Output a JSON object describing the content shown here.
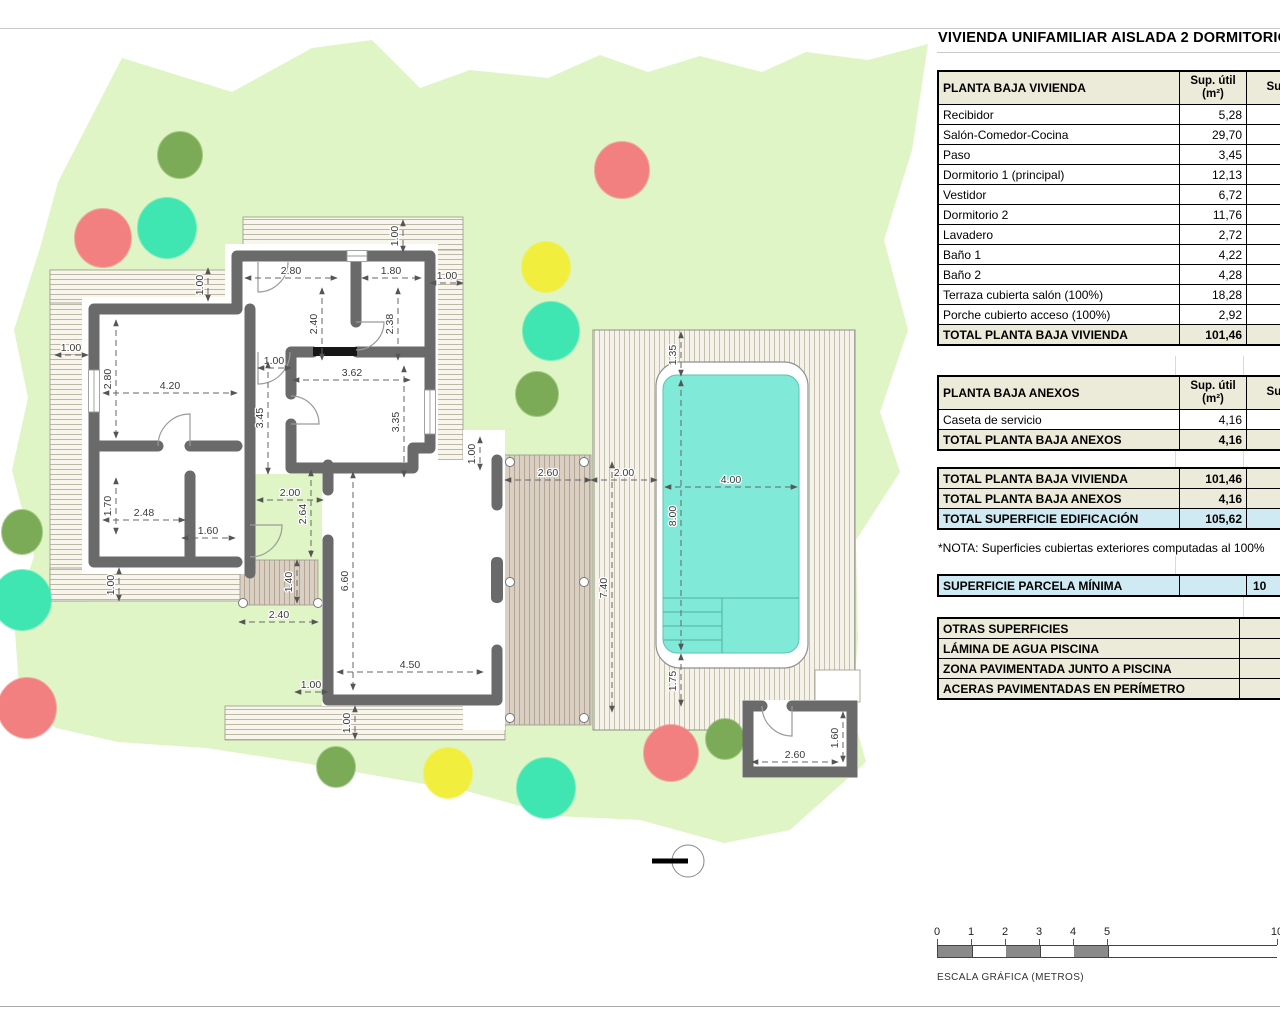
{
  "title": "VIVIENDA UNIFAMILIAR AISLADA 2 DORMITORIOS",
  "panel": {
    "vivienda": {
      "header": "PLANTA BAJA VIVIENDA",
      "col_sup_util": "Sup. útil (m²)",
      "col_sup_2": "Sup.",
      "rows": [
        [
          "Recibidor",
          "5,28"
        ],
        [
          "Salón-Comedor-Cocina",
          "29,70"
        ],
        [
          "Paso",
          "3,45"
        ],
        [
          "Dormitorio 1 (principal)",
          "12,13"
        ],
        [
          "Vestidor",
          "6,72"
        ],
        [
          "Dormitorio 2",
          "11,76"
        ],
        [
          "Lavadero",
          "2,72"
        ],
        [
          "Baño 1",
          "4,22"
        ],
        [
          "Baño 2",
          "4,28"
        ],
        [
          "Terraza cubierta salón (100%)",
          "18,28"
        ],
        [
          "Porche cubierto acceso (100%)",
          "2,92"
        ]
      ],
      "total_label": "TOTAL PLANTA BAJA VIVIENDA",
      "total_value": "101,46"
    },
    "anexos": {
      "header": "PLANTA BAJA ANEXOS",
      "col_sup_util": "Sup. útil (m²)",
      "col_sup_2": "Sup.",
      "rows": [
        [
          "Caseta de servicio",
          "4,16"
        ]
      ],
      "total_label": "TOTAL PLANTA BAJA ANEXOS",
      "total_value": "4,16"
    },
    "resumen": [
      [
        "TOTAL PLANTA BAJA VIVIENDA",
        "101,46",
        "beigerow"
      ],
      [
        "TOTAL PLANTA BAJA ANEXOS",
        "4,16",
        "beigerow"
      ],
      [
        "TOTAL SUPERFICIE EDIFICACIÓN",
        "105,62",
        "blue"
      ]
    ],
    "nota": "*NOTA: Superficies cubiertas exteriores computadas al 100%",
    "parcela_label": "SUPERFICIE PARCELA MÍNIMA",
    "parcela_value": "10",
    "otras_header": "OTRAS SUPERFICIES",
    "otras_rows": [
      "LÁMINA DE AGUA PISCINA",
      "ZONA PAVIMENTADA JUNTO A PISCINA",
      "ACERAS PAVIMENTADAS EN PERÍMETRO"
    ]
  },
  "scalebar": {
    "labels": [
      "0",
      "1",
      "2",
      "3",
      "4",
      "5",
      "10"
    ],
    "caption": "ESCALA GRÁFICA (METROS)"
  },
  "plan": {
    "colors": {
      "garden": "#dff5c5",
      "wall": "#6a6a6a",
      "water": "#80e9d8",
      "tree_red": "#f28080",
      "tree_teal": "#3fe6b2",
      "tree_yellow": "#f1ee3d",
      "tree_olive": "#7cab57"
    },
    "dims": [
      [
        "4.20",
        103,
        393,
        237,
        393,
        170,
        389,
        0
      ],
      [
        "2.80",
        116,
        320,
        116,
        438,
        111,
        379,
        1
      ],
      [
        "1.00",
        55,
        355,
        88,
        355,
        71,
        351,
        0
      ],
      [
        "1.70",
        116,
        478,
        116,
        534,
        111,
        506,
        1
      ],
      [
        "2.48",
        103,
        520,
        185,
        520,
        144,
        516,
        0
      ],
      [
        "1.60",
        182,
        538,
        235,
        538,
        208,
        534,
        0
      ],
      [
        "1.00",
        208,
        268,
        208,
        301,
        203,
        285,
        1
      ],
      [
        "2.80",
        245,
        278,
        337,
        278,
        291,
        274,
        0
      ],
      [
        "2.40",
        322,
        288,
        322,
        360,
        317,
        324,
        1
      ],
      [
        "1.80",
        362,
        278,
        421,
        278,
        391,
        274,
        0
      ],
      [
        "2.38",
        398,
        288,
        398,
        360,
        393,
        324,
        1
      ],
      [
        "1.00",
        430,
        283,
        463,
        283,
        447,
        279,
        0
      ],
      [
        "1.00",
        403,
        220,
        403,
        252,
        398,
        236,
        1
      ],
      [
        "1.00",
        258,
        368,
        291,
        368,
        274,
        364,
        0
      ],
      [
        "3.62",
        293,
        380,
        410,
        380,
        352,
        376,
        0
      ],
      [
        "3.45",
        268,
        362,
        268,
        474,
        263,
        418,
        1
      ],
      [
        "3.35",
        404,
        366,
        404,
        477,
        399,
        422,
        1
      ],
      [
        "2.00",
        257,
        500,
        323,
        500,
        290,
        496,
        0
      ],
      [
        "2.64",
        311,
        470,
        311,
        557,
        306,
        514,
        1
      ],
      [
        "6.60",
        353,
        472,
        353,
        690,
        348,
        581,
        1
      ],
      [
        "4.50",
        337,
        672,
        483,
        672,
        410,
        668,
        0
      ],
      [
        "1.00",
        295,
        692,
        328,
        692,
        311,
        688,
        0
      ],
      [
        "1.00",
        355,
        706,
        355,
        739,
        350,
        723,
        1
      ],
      [
        "1.00",
        119,
        568,
        119,
        601,
        114,
        585,
        1
      ],
      [
        "2.40",
        239,
        622,
        318,
        622,
        279,
        618,
        0
      ],
      [
        "1.40",
        297,
        560,
        297,
        603,
        292,
        582,
        1
      ],
      [
        "1.00",
        480,
        437,
        480,
        470,
        475,
        454,
        1
      ],
      [
        "2.60",
        505,
        480,
        591,
        480,
        548,
        476,
        0
      ],
      [
        "2.00",
        591,
        480,
        657,
        480,
        624,
        476,
        0
      ],
      [
        "7.40",
        612,
        462,
        612,
        712,
        607,
        588,
        1
      ],
      [
        "1.35",
        681,
        332,
        681,
        376,
        676,
        355,
        1
      ],
      [
        "4.00",
        665,
        487,
        797,
        487,
        731,
        483,
        0
      ],
      [
        "8.00",
        681,
        380,
        681,
        650,
        676,
        516,
        1
      ],
      [
        "1.75",
        681,
        654,
        681,
        706,
        676,
        681,
        1
      ],
      [
        "2.60",
        752,
        762,
        838,
        762,
        795,
        758,
        0
      ],
      [
        "1.60",
        843,
        712,
        843,
        762,
        838,
        738,
        1
      ]
    ],
    "trees": [
      [
        "olive",
        180,
        155,
        22,
        23
      ],
      [
        "red",
        622,
        170,
        27,
        28
      ],
      [
        "red",
        103,
        238,
        28,
        29
      ],
      [
        "teal",
        167,
        228,
        29,
        30
      ],
      [
        "yellow",
        546,
        267,
        24,
        25
      ],
      [
        "teal",
        551,
        331,
        28,
        29
      ],
      [
        "olive",
        537,
        394,
        21,
        22
      ],
      [
        "olive",
        22,
        532,
        20,
        22
      ],
      [
        "teal",
        22,
        600,
        29,
        30
      ],
      [
        "red",
        27,
        708,
        29,
        30
      ],
      [
        "olive",
        336,
        767,
        19,
        20
      ],
      [
        "yellow",
        448,
        773,
        24,
        25
      ],
      [
        "teal",
        546,
        788,
        29,
        30
      ],
      [
        "red",
        671,
        753,
        27,
        28
      ],
      [
        "olive",
        725,
        739,
        19,
        20
      ]
    ]
  }
}
